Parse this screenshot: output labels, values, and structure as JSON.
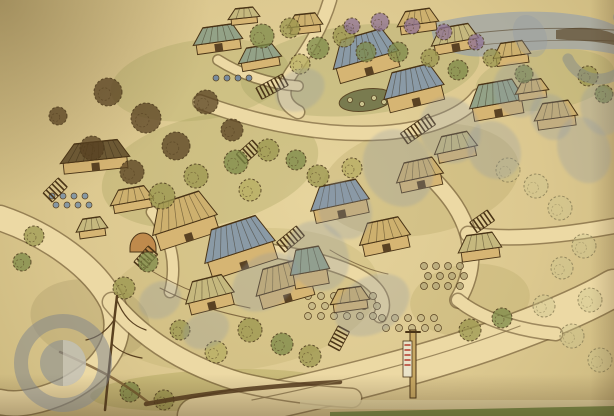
{
  "meta": {
    "description": "Photograph of a hand-drawn aerial perspective site plan of a hillside village resort, pen-and-ink with watercolor wash on cream paper, overlaid with a semi-transparent stock-agency watermark",
    "media": "ink and watercolor sketch"
  },
  "palette": {
    "paper": "#dcc88f",
    "ink": "#4a3416",
    "road": "#ecd9a4",
    "road_edge": "#6b5330",
    "wall": "#d6b573",
    "roofs": {
      "T": "#93a287",
      "N": "#cdb06e",
      "D": "#6e5a35",
      "B": "#8a9aa6",
      "P": "#c5b87e"
    },
    "trees": {
      "o": "#9a954e",
      "g": "#7c8a48",
      "y": "#b7ae62",
      "d": "#584222",
      "p": "#8e7296",
      "l": "#c9c28d"
    }
  },
  "scene": {
    "washes": [
      [
        200,
        80,
        90,
        40,
        -8,
        "#a3a059",
        0.28
      ],
      [
        360,
        70,
        120,
        45,
        -6,
        "#9aa05c",
        0.3
      ],
      [
        210,
        170,
        110,
        55,
        -12,
        "#a3a059",
        0.3
      ],
      [
        420,
        180,
        100,
        55,
        -10,
        "#ac9d5e",
        0.26
      ],
      [
        240,
        300,
        140,
        70,
        -8,
        "#b0a35f",
        0.22
      ],
      [
        470,
        300,
        60,
        36,
        -6,
        "#a79a58",
        0.22
      ],
      [
        210,
        390,
        120,
        20,
        -3,
        "#aaa254",
        0.4
      ],
      [
        90,
        320,
        60,
        40,
        10,
        "#8e7c4e",
        0.2
      ],
      [
        545,
        80,
        70,
        30,
        -8,
        "#9aa05c",
        0.25
      ]
    ],
    "backdrop": [
      {
        "t": "path",
        "d": "M430,24 C468,14 520,9 562,13 C592,16 606,21 614,25 L614,54 C578,46 538,48 498,55 C468,60 446,52 434,42 Z",
        "fill": "#95a0ac",
        "o": 0.65,
        "n": "distant-lake-hills"
      },
      {
        "t": "path",
        "d": "M556,30 C584,25 604,29 614,34 L614,45 C592,40 572,41 556,39 Z",
        "fill": "#5d4a2e",
        "o": 0.7,
        "n": "distant-headland"
      },
      {
        "t": "path",
        "d": "M436,40 C480,30 540,26 614,30",
        "stroke": "#4f3c22",
        "sw": 1,
        "o": 0.55,
        "n": "horizon-stroke"
      },
      {
        "t": "path",
        "d": "M450,49 C500,41 560,39 614,41",
        "stroke": "#4f3c22",
        "sw": 0.8,
        "o": 0.5,
        "n": "horizon-stroke"
      }
    ],
    "roads": [
      [
        "M196,416 C290,398 400,372 488,342 C545,322 585,305 614,288",
        36
      ],
      [
        "M0,218 C50,235 95,268 112,302 C126,336 108,368 66,390 C40,402 16,406 0,402",
        24
      ],
      [
        "M112,302 C140,336 180,364 240,382 C280,392 320,396 352,398",
        18
      ],
      [
        "M330,0 C322,28 306,52 292,72 C280,90 282,104 298,112",
        12
      ],
      [
        "M200,102 C260,124 330,138 392,132 C438,127 466,112 478,96",
        13
      ],
      [
        "M430,176 C452,198 462,214 468,234 C474,258 470,280 458,300",
        15
      ],
      [
        "M468,234 C500,240 548,238 614,226",
        14
      ],
      [
        "M458,300 C480,318 516,330 556,334",
        12
      ],
      [
        "M240,246 C282,252 320,258 352,272 C378,284 388,300 380,316",
        12
      ],
      [
        "M218,60 C240,74 268,84 298,86",
        9
      ],
      [
        "M152,212 C170,236 178,262 170,292",
        10
      ]
    ],
    "features": [
      {
        "t": "ellipse",
        "cx": 366,
        "cy": 100,
        "rx": 27,
        "ry": 11,
        "rot": -8,
        "fill": "#6b7046",
        "stroke": "#4a3416",
        "sw": 1,
        "o": 0.85,
        "n": "pond"
      },
      {
        "t": "circle",
        "cx": 350,
        "cy": 100,
        "r": 2.5,
        "fill": "#c9c28d",
        "stroke": "#4a3416",
        "sw": 0.6,
        "n": "pond-stone"
      },
      {
        "t": "circle",
        "cx": 362,
        "cy": 104,
        "r": 2.5,
        "fill": "#c9c28d",
        "stroke": "#4a3416",
        "sw": 0.6,
        "n": "pond-stone"
      },
      {
        "t": "circle",
        "cx": 374,
        "cy": 98,
        "r": 2.5,
        "fill": "#c9c28d",
        "stroke": "#4a3416",
        "sw": 0.6,
        "n": "pond-stone"
      },
      {
        "t": "circle",
        "cx": 384,
        "cy": 102,
        "r": 2.5,
        "fill": "#c9c28d",
        "stroke": "#4a3416",
        "sw": 0.6,
        "n": "pond-stone"
      },
      {
        "t": "path",
        "d": "M130,248 a13,15 0 0 1 26,0 l0,4 l-26,0 z",
        "fill": "#bf8a4c",
        "stroke": "#4a3416",
        "sw": 1,
        "n": "arch-gate"
      },
      {
        "t": "path",
        "d": "M150,270 C180,288 210,300 250,308 M160,288 C190,304 224,314 258,320",
        "stroke": "#6b5330",
        "sw": 1,
        "o": 0.8,
        "n": "terrace-lines"
      },
      {
        "t": "path",
        "d": "M330,250 C350,262 368,270 388,274",
        "stroke": "#6b5330",
        "sw": 1,
        "o": 0.7,
        "n": "terrace-lines"
      },
      {
        "t": "path",
        "d": "M236,252 l2,-6 M244,255 l2,-6 M252,258 l2,-6",
        "stroke": "#3c2a12",
        "sw": 1.4,
        "n": "path-figures"
      }
    ],
    "jars": [
      [
        308,
        296,
        6,
        3,
        3.5,
        13,
        10,
        "#c6b887"
      ],
      [
        382,
        318,
        5,
        2,
        3.5,
        13,
        10,
        "#c6b887"
      ],
      [
        424,
        266,
        4,
        3,
        3.5,
        12,
        10,
        "#b9ab7c"
      ],
      [
        52,
        196,
        4,
        2,
        3,
        11,
        9,
        "#7d93a6"
      ],
      [
        216,
        78,
        4,
        1,
        3,
        11,
        9,
        "#6f86a0"
      ]
    ],
    "buildings": [
      [
        218,
        42,
        44,
        16,
        -8,
        "T"
      ],
      [
        260,
        60,
        38,
        14,
        -10,
        "T"
      ],
      [
        305,
        26,
        30,
        12,
        -6,
        "N"
      ],
      [
        418,
        24,
        36,
        14,
        -8,
        "N"
      ],
      [
        455,
        42,
        42,
        16,
        -10,
        "P"
      ],
      [
        366,
        60,
        62,
        26,
        -16,
        "B"
      ],
      [
        414,
        92,
        56,
        24,
        -14,
        "B"
      ],
      [
        497,
        104,
        50,
        22,
        -10,
        "T"
      ],
      [
        556,
        118,
        38,
        16,
        -8,
        "N"
      ],
      [
        95,
        160,
        64,
        18,
        -6,
        "D"
      ],
      [
        132,
        202,
        38,
        14,
        -10,
        "N"
      ],
      [
        185,
        225,
        62,
        28,
        -18,
        "N"
      ],
      [
        240,
        252,
        68,
        30,
        -18,
        "B"
      ],
      [
        285,
        288,
        54,
        24,
        -16,
        "N"
      ],
      [
        210,
        298,
        44,
        20,
        -14,
        "P"
      ],
      [
        340,
        205,
        54,
        22,
        -12,
        "B"
      ],
      [
        385,
        240,
        46,
        20,
        -12,
        "N"
      ],
      [
        310,
        272,
        34,
        24,
        -10,
        "T"
      ],
      [
        350,
        302,
        34,
        14,
        -8,
        "N"
      ],
      [
        480,
        250,
        38,
        16,
        -8,
        "P"
      ],
      [
        532,
        92,
        28,
        12,
        -8,
        "N"
      ],
      [
        92,
        230,
        26,
        12,
        -8,
        "P"
      ],
      [
        420,
        178,
        42,
        18,
        -12,
        "N"
      ],
      [
        456,
        150,
        38,
        16,
        -12,
        "P"
      ],
      [
        512,
        56,
        32,
        14,
        -8,
        "N"
      ],
      [
        244,
        18,
        26,
        10,
        -6,
        "P"
      ]
    ],
    "stairs": [
      [
        282,
        74,
        8,
        62
      ],
      [
        428,
        114,
        9,
        55
      ],
      [
        148,
        246,
        6,
        42
      ],
      [
        296,
        226,
        7,
        50
      ],
      [
        58,
        178,
        6,
        45
      ],
      [
        338,
        326,
        6,
        28
      ],
      [
        487,
        210,
        6,
        55
      ],
      [
        252,
        140,
        6,
        48
      ]
    ],
    "trees": [
      [
        108,
        92,
        14,
        "d"
      ],
      [
        146,
        118,
        15,
        "d"
      ],
      [
        92,
        148,
        12,
        "d"
      ],
      [
        176,
        146,
        14,
        "d"
      ],
      [
        132,
        172,
        12,
        "d"
      ],
      [
        58,
        116,
        9,
        "d"
      ],
      [
        206,
        102,
        12,
        "d"
      ],
      [
        232,
        130,
        11,
        "d"
      ],
      [
        162,
        196,
        13,
        "o"
      ],
      [
        196,
        176,
        12,
        "o"
      ],
      [
        236,
        162,
        12,
        "g"
      ],
      [
        268,
        150,
        11,
        "o"
      ],
      [
        296,
        160,
        10,
        "g"
      ],
      [
        250,
        190,
        11,
        "y"
      ],
      [
        262,
        36,
        12,
        "g"
      ],
      [
        290,
        28,
        10,
        "o"
      ],
      [
        318,
        48,
        11,
        "g"
      ],
      [
        344,
        36,
        11,
        "o"
      ],
      [
        366,
        52,
        10,
        "g"
      ],
      [
        300,
        64,
        10,
        "y"
      ],
      [
        352,
        26,
        8,
        "p"
      ],
      [
        380,
        22,
        9,
        "p"
      ],
      [
        412,
        26,
        8,
        "p"
      ],
      [
        444,
        32,
        8,
        "p"
      ],
      [
        476,
        42,
        8,
        "p"
      ],
      [
        398,
        52,
        10,
        "g"
      ],
      [
        430,
        58,
        9,
        "o"
      ],
      [
        458,
        70,
        10,
        "g"
      ],
      [
        492,
        58,
        9,
        "o"
      ],
      [
        524,
        74,
        9,
        "g"
      ],
      [
        318,
        176,
        11,
        "o"
      ],
      [
        352,
        168,
        10,
        "y"
      ],
      [
        508,
        170,
        12,
        "l"
      ],
      [
        536,
        186,
        12,
        "l"
      ],
      [
        560,
        208,
        12,
        "l"
      ],
      [
        584,
        246,
        12,
        "l"
      ],
      [
        562,
        268,
        11,
        "l"
      ],
      [
        590,
        300,
        12,
        "l"
      ],
      [
        544,
        306,
        11,
        "l"
      ],
      [
        572,
        336,
        12,
        "l"
      ],
      [
        600,
        360,
        12,
        "l"
      ],
      [
        250,
        330,
        12,
        "o"
      ],
      [
        282,
        344,
        11,
        "g"
      ],
      [
        216,
        352,
        11,
        "y"
      ],
      [
        180,
        330,
        10,
        "o"
      ],
      [
        310,
        356,
        11,
        "o"
      ],
      [
        130,
        392,
        10,
        "g"
      ],
      [
        164,
        400,
        10,
        "o"
      ],
      [
        34,
        236,
        10,
        "o"
      ],
      [
        22,
        262,
        9,
        "g"
      ],
      [
        148,
        262,
        10,
        "g"
      ],
      [
        124,
        288,
        11,
        "o"
      ],
      [
        588,
        76,
        10,
        "o"
      ],
      [
        604,
        94,
        9,
        "g"
      ],
      [
        470,
        330,
        11,
        "o"
      ],
      [
        502,
        318,
        10,
        "g"
      ]
    ],
    "details": [
      {
        "t": "path",
        "d": "M117,296 C113,330 109,368 105,410",
        "stroke": "#5a4120",
        "sw": 2.5,
        "n": "sketch-tree-trunk"
      },
      {
        "t": "path",
        "d": "M117,300 C124,318 134,326 146,330 M114,320 C106,332 96,338 86,340 M112,344 C120,352 130,356 142,358",
        "stroke": "#5a4120",
        "sw": 1.2,
        "n": "sketch-tree-branches"
      },
      {
        "t": "path",
        "d": "M146,404 C210,392 268,386 340,382",
        "stroke": "#53381c",
        "sw": 4.5,
        "o": 0.85,
        "n": "ink-slope-stroke"
      },
      {
        "t": "path",
        "d": "M60,352 C96,368 120,380 148,402",
        "stroke": "#6a4a24",
        "sw": 2.5,
        "o": 0.7,
        "n": "ink-slope-stroke"
      },
      {
        "t": "path",
        "d": "M252,400 C340,382 430,360 520,326",
        "stroke": "#8a744c",
        "sw": 1.2,
        "o": 0.8,
        "n": "road-wheel-line"
      },
      {
        "t": "rect",
        "x": 410,
        "y": 330,
        "w": 6,
        "h": 68,
        "fill": "#c8a964",
        "stroke": "#4a3416",
        "sw": 1,
        "n": "banner-gate-post"
      },
      {
        "t": "rect",
        "x": 403,
        "y": 341,
        "w": 9,
        "h": 36,
        "fill": "#eae3c9",
        "stroke": "#4a3416",
        "sw": 0.8,
        "n": "banner-flag"
      },
      {
        "t": "path",
        "d": "M405,345 h5 M405,350 h5 M405,355 h5 M405,360 h5 M405,365 h5",
        "stroke": "#b23b2a",
        "sw": 1.5,
        "n": "banner-stripes"
      },
      {
        "t": "path",
        "d": "M406,332 h14",
        "stroke": "#4a3416",
        "sw": 2,
        "n": "banner-gate-cap"
      },
      {
        "t": "rect",
        "x": 300,
        "y": 400,
        "w": 314,
        "h": 9,
        "fill": "#e9dcab",
        "o": 0.75,
        "n": "paper-edge-band"
      },
      {
        "t": "path",
        "d": "M330,412 L614,406 L614,416 L330,416 Z",
        "fill": "#7d9049",
        "n": "photo-table-edge"
      }
    ]
  },
  "watermark": {
    "color": "#8d98a6",
    "glyph_opacity": 0.27,
    "glyphs": [
      [
        265,
        282,
        36,
        26,
        -35
      ],
      [
        318,
        256,
        30,
        36,
        -25
      ],
      [
        372,
        305,
        40,
        28,
        -30
      ],
      [
        398,
        168,
        34,
        40,
        -28
      ],
      [
        450,
        130,
        30,
        34,
        -24
      ],
      [
        494,
        150,
        26,
        30,
        -30
      ],
      [
        518,
        90,
        24,
        28,
        -22
      ],
      [
        551,
        117,
        20,
        24,
        -28
      ],
      [
        300,
        90,
        26,
        20,
        -30
      ],
      [
        160,
        300,
        22,
        18,
        -30
      ],
      [
        206,
        330,
        24,
        18,
        -25
      ],
      [
        584,
        150,
        26,
        34,
        -20
      ],
      [
        601,
        110,
        20,
        26,
        -20
      ],
      [
        345,
        210,
        26,
        30,
        -28
      ]
    ],
    "marks": [
      {
        "t": "circle",
        "cx": 63,
        "cy": 363,
        "r": 42,
        "stroke": "rgba(125,132,140,0.5)",
        "sw": 14,
        "n": "watermark-logo-ring"
      },
      {
        "t": "circle",
        "cx": 63,
        "cy": 363,
        "r": 23,
        "fill": "rgba(133,140,148,0.55)",
        "n": "watermark-logo-disc"
      },
      {
        "t": "path",
        "d": "M63,340 a23,23 0 0 1 0,46 z",
        "fill": "rgba(222,216,200,0.55)",
        "n": "watermark-logo-crescent"
      },
      {
        "t": "circle",
        "cx": 599,
        "cy": 45,
        "r": 34,
        "stroke": "rgba(125,132,140,0.45)",
        "sw": 11,
        "dash": "125 92",
        "rot": -55,
        "n": "watermark-arc"
      },
      {
        "t": "ellipse",
        "cx": 530,
        "cy": 36,
        "rx": 16,
        "ry": 22,
        "rot": -25,
        "fill": "rgba(141,152,166,0.3)",
        "n": "watermark-glyph"
      }
    ]
  }
}
